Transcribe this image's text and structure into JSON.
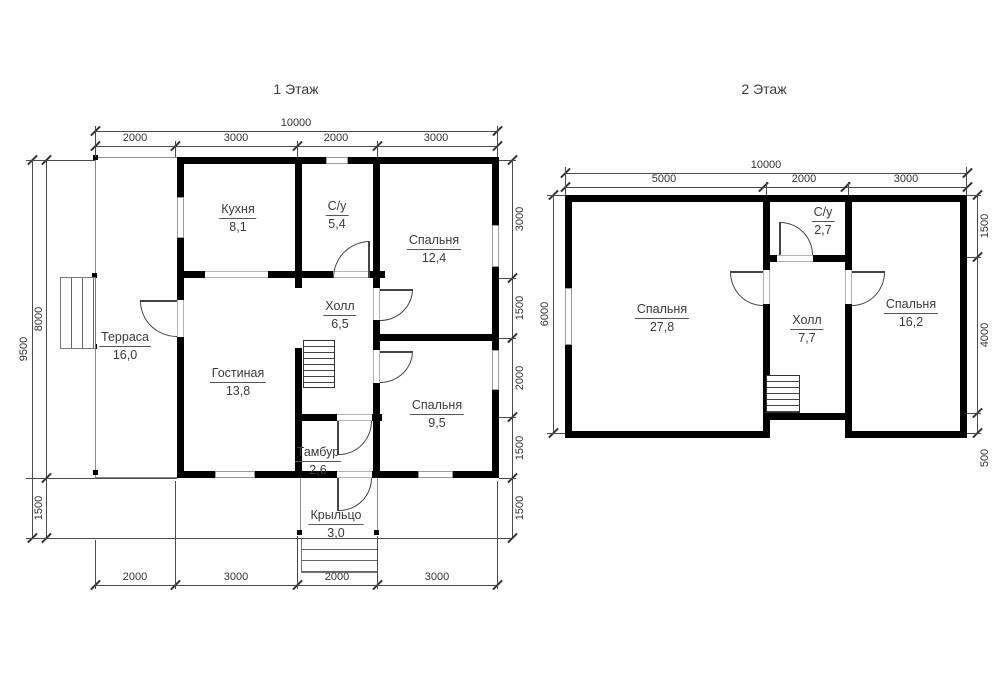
{
  "style": {
    "wall_color": "#000000",
    "line_color": "#4a4a4a",
    "text_color": "#3a3a3a",
    "background": "#ffffff"
  },
  "floor1": {
    "title": "1 Этаж",
    "rooms": [
      {
        "name": "Терраса",
        "area": "16,0"
      },
      {
        "name": "Кухня",
        "area": "8,1"
      },
      {
        "name": "С/у",
        "area": "5,4"
      },
      {
        "name": "Спальня",
        "area": "12,4"
      },
      {
        "name": "Холл",
        "area": "6,5"
      },
      {
        "name": "Гостиная",
        "area": "13,8"
      },
      {
        "name": "Спальня",
        "area": "9,5"
      },
      {
        "name": "Тамбур",
        "area": "2,6"
      },
      {
        "name": "Крыльцо",
        "area": "3,0"
      }
    ],
    "dims": {
      "top_total": "10000",
      "top_segments": [
        "2000",
        "3000",
        "2000",
        "3000"
      ],
      "bottom_segments": [
        "2000",
        "3000",
        "2000",
        "3000"
      ],
      "left_total": "9500",
      "left_segments": [
        "8000",
        "1500"
      ],
      "right_segments": [
        "3000",
        "1500",
        "2000",
        "1500",
        "1500"
      ]
    }
  },
  "floor2": {
    "title": "2 Этаж",
    "rooms": [
      {
        "name": "Спальня",
        "area": "27,8"
      },
      {
        "name": "С/у",
        "area": "2,7"
      },
      {
        "name": "Холл",
        "area": "7,7"
      },
      {
        "name": "Спальня",
        "area": "16,2"
      }
    ],
    "dims": {
      "top_total": "10000",
      "top_segments": [
        "5000",
        "2000",
        "3000"
      ],
      "left_total": "6000",
      "right_segments": [
        "1500",
        "4000",
        "500"
      ]
    }
  }
}
